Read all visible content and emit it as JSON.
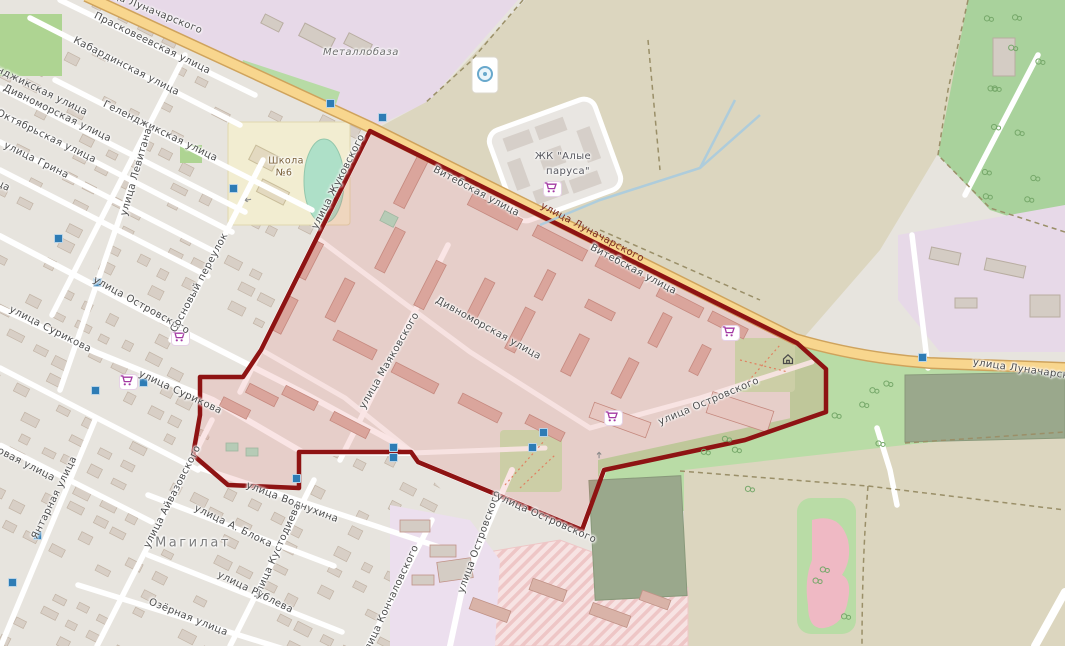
{
  "map": {
    "place": "Магилат",
    "highlighted_area": {
      "description": "district boundary polygon",
      "stroke_color": "#8e1313",
      "fill_color": "rgba(224,96,96,0.16)"
    },
    "colors": {
      "primary_road": "#f8d68e",
      "primary_road_casing": "#cfa35c",
      "farmland": "#dcd6bf",
      "forest": "#a9d29c",
      "grass": "#b9dca6",
      "residential": "#e7e4de",
      "industrial": "#e7d9e8",
      "school_yard": "#f2edd1",
      "pitch": "#aee0c8",
      "sports_field": "#9aa88c",
      "building": "#d8cfc6",
      "building_tinted": "#d9b3a8",
      "shop_icon": "#a339a3",
      "blue_marker": "#2e7cb5",
      "water": "#a6cbe0"
    },
    "labels": [
      {
        "t": "улица Луначарского",
        "x": 148,
        "y": 10,
        "r": 22,
        "c": "lbl"
      },
      {
        "t": "Прасковеевская улица",
        "x": 152,
        "y": 44,
        "r": 26,
        "c": "lbl"
      },
      {
        "t": "Кабардинская улица",
        "x": 126,
        "y": 67,
        "r": 27,
        "c": "lbl"
      },
      {
        "t": "Геленджикская улица",
        "x": 30,
        "y": 86,
        "r": 26,
        "c": "lbl"
      },
      {
        "t": "Геленджикская улица",
        "x": 160,
        "y": 132,
        "r": 26,
        "c": "lbl"
      },
      {
        "t": "Дивноморская улица",
        "x": 57,
        "y": 114,
        "r": 26,
        "c": "lbl"
      },
      {
        "t": "Октябрьская улица",
        "x": 46,
        "y": 137,
        "r": 26,
        "c": "lbl"
      },
      {
        "t": "улица Грина",
        "x": 36,
        "y": 161,
        "r": 26,
        "c": "lbl"
      },
      {
        "t": "улица",
        "x": -6,
        "y": 182,
        "r": 26,
        "c": "lbl"
      },
      {
        "t": "улица Левитана",
        "x": 137,
        "y": 172,
        "r": -74,
        "c": "lbl"
      },
      {
        "t": "Металлобаза",
        "x": 361,
        "y": 53,
        "r": 0,
        "c": "lbl poi-italic"
      },
      {
        "t": "Школа",
        "x": 286,
        "y": 161,
        "r": 0,
        "c": "lbl poi-school"
      },
      {
        "t": "№6",
        "x": 284,
        "y": 173,
        "r": 0,
        "c": "lbl poi-school"
      },
      {
        "t": "улица Жуковского",
        "x": 339,
        "y": 182,
        "r": -63,
        "c": "lbl"
      },
      {
        "t": "Витебская улица",
        "x": 476,
        "y": 192,
        "r": 28,
        "c": "lbl"
      },
      {
        "t": "улица Луначарского",
        "x": 592,
        "y": 233,
        "r": 28,
        "c": "lbl street-dark"
      },
      {
        "t": "Витебская улица",
        "x": 633,
        "y": 270,
        "r": 28,
        "c": "lbl"
      },
      {
        "t": "ЖК \"Алые",
        "x": 563,
        "y": 157,
        "r": 0,
        "c": "lbl poi"
      },
      {
        "t": "паруса\"",
        "x": 568,
        "y": 172,
        "r": 0,
        "c": "lbl poi"
      },
      {
        "t": "улица Луначарского",
        "x": 1030,
        "y": 371,
        "r": 8,
        "c": "lbl"
      },
      {
        "t": "Дивноморская улица",
        "x": 488,
        "y": 329,
        "r": 29,
        "c": "lbl"
      },
      {
        "t": "улица Маяковского",
        "x": 390,
        "y": 361,
        "r": -60,
        "c": "lbl"
      },
      {
        "t": "улица Островского",
        "x": 709,
        "y": 402,
        "r": -23,
        "c": "lbl"
      },
      {
        "t": "улица Островского",
        "x": 141,
        "y": 306,
        "r": 29,
        "c": "lbl"
      },
      {
        "t": "Сосновый переулок",
        "x": 200,
        "y": 283,
        "r": -62,
        "c": "lbl"
      },
      {
        "t": "улица Сурикова",
        "x": 50,
        "y": 330,
        "r": 27,
        "c": "lbl"
      },
      {
        "t": "улица Сурикова",
        "x": 180,
        "y": 393,
        "r": 25,
        "c": "lbl"
      },
      {
        "t": "Сосновая улица",
        "x": 14,
        "y": 459,
        "r": 27,
        "c": "lbl"
      },
      {
        "t": "Янтарная улица",
        "x": 55,
        "y": 498,
        "r": -64,
        "c": "lbl"
      },
      {
        "t": "улица Айвазовского",
        "x": 173,
        "y": 497,
        "r": -63,
        "c": "lbl"
      },
      {
        "t": "улица А. Блока",
        "x": 233,
        "y": 527,
        "r": 26,
        "c": "lbl"
      },
      {
        "t": "Магилат",
        "x": 193,
        "y": 543,
        "r": 0,
        "c": "lbl place"
      },
      {
        "t": "улица Волнухина",
        "x": 292,
        "y": 503,
        "r": 21,
        "c": "lbl"
      },
      {
        "t": "улица Кустодиева",
        "x": 278,
        "y": 551,
        "r": -66,
        "c": "lbl"
      },
      {
        "t": "улица Рублева",
        "x": 255,
        "y": 593,
        "r": 26,
        "c": "lbl"
      },
      {
        "t": "Озёрная улица",
        "x": 188,
        "y": 618,
        "r": 22,
        "c": "lbl"
      },
      {
        "t": "улица Кончаловского",
        "x": 391,
        "y": 601,
        "r": -65,
        "c": "lbl"
      },
      {
        "t": "улица Островского",
        "x": 480,
        "y": 542,
        "r": -70,
        "c": "lbl"
      },
      {
        "t": "улица Островского",
        "x": 546,
        "y": 519,
        "r": 24,
        "c": "lbl"
      }
    ],
    "icons": {
      "shopping_carts": [
        [
          552,
          189
        ],
        [
          730,
          333
        ],
        [
          613,
          418
        ],
        [
          180,
          338
        ],
        [
          128,
          382
        ]
      ],
      "blue_markers": [
        [
          330,
          103
        ],
        [
          382,
          117
        ],
        [
          233,
          188
        ],
        [
          58,
          238
        ],
        [
          97,
          282
        ],
        [
          143,
          382
        ],
        [
          95,
          390
        ],
        [
          296,
          478
        ],
        [
          393,
          447
        ],
        [
          393,
          457
        ],
        [
          532,
          447
        ],
        [
          543,
          432
        ],
        [
          922,
          357
        ],
        [
          37,
          535
        ],
        [
          12,
          582
        ]
      ],
      "house": [
        788,
        359
      ],
      "fountain": [
        485,
        73
      ],
      "oneway_arrows": [
        [
          601,
          456,
          -90
        ],
        [
          249,
          200,
          170
        ]
      ]
    }
  }
}
